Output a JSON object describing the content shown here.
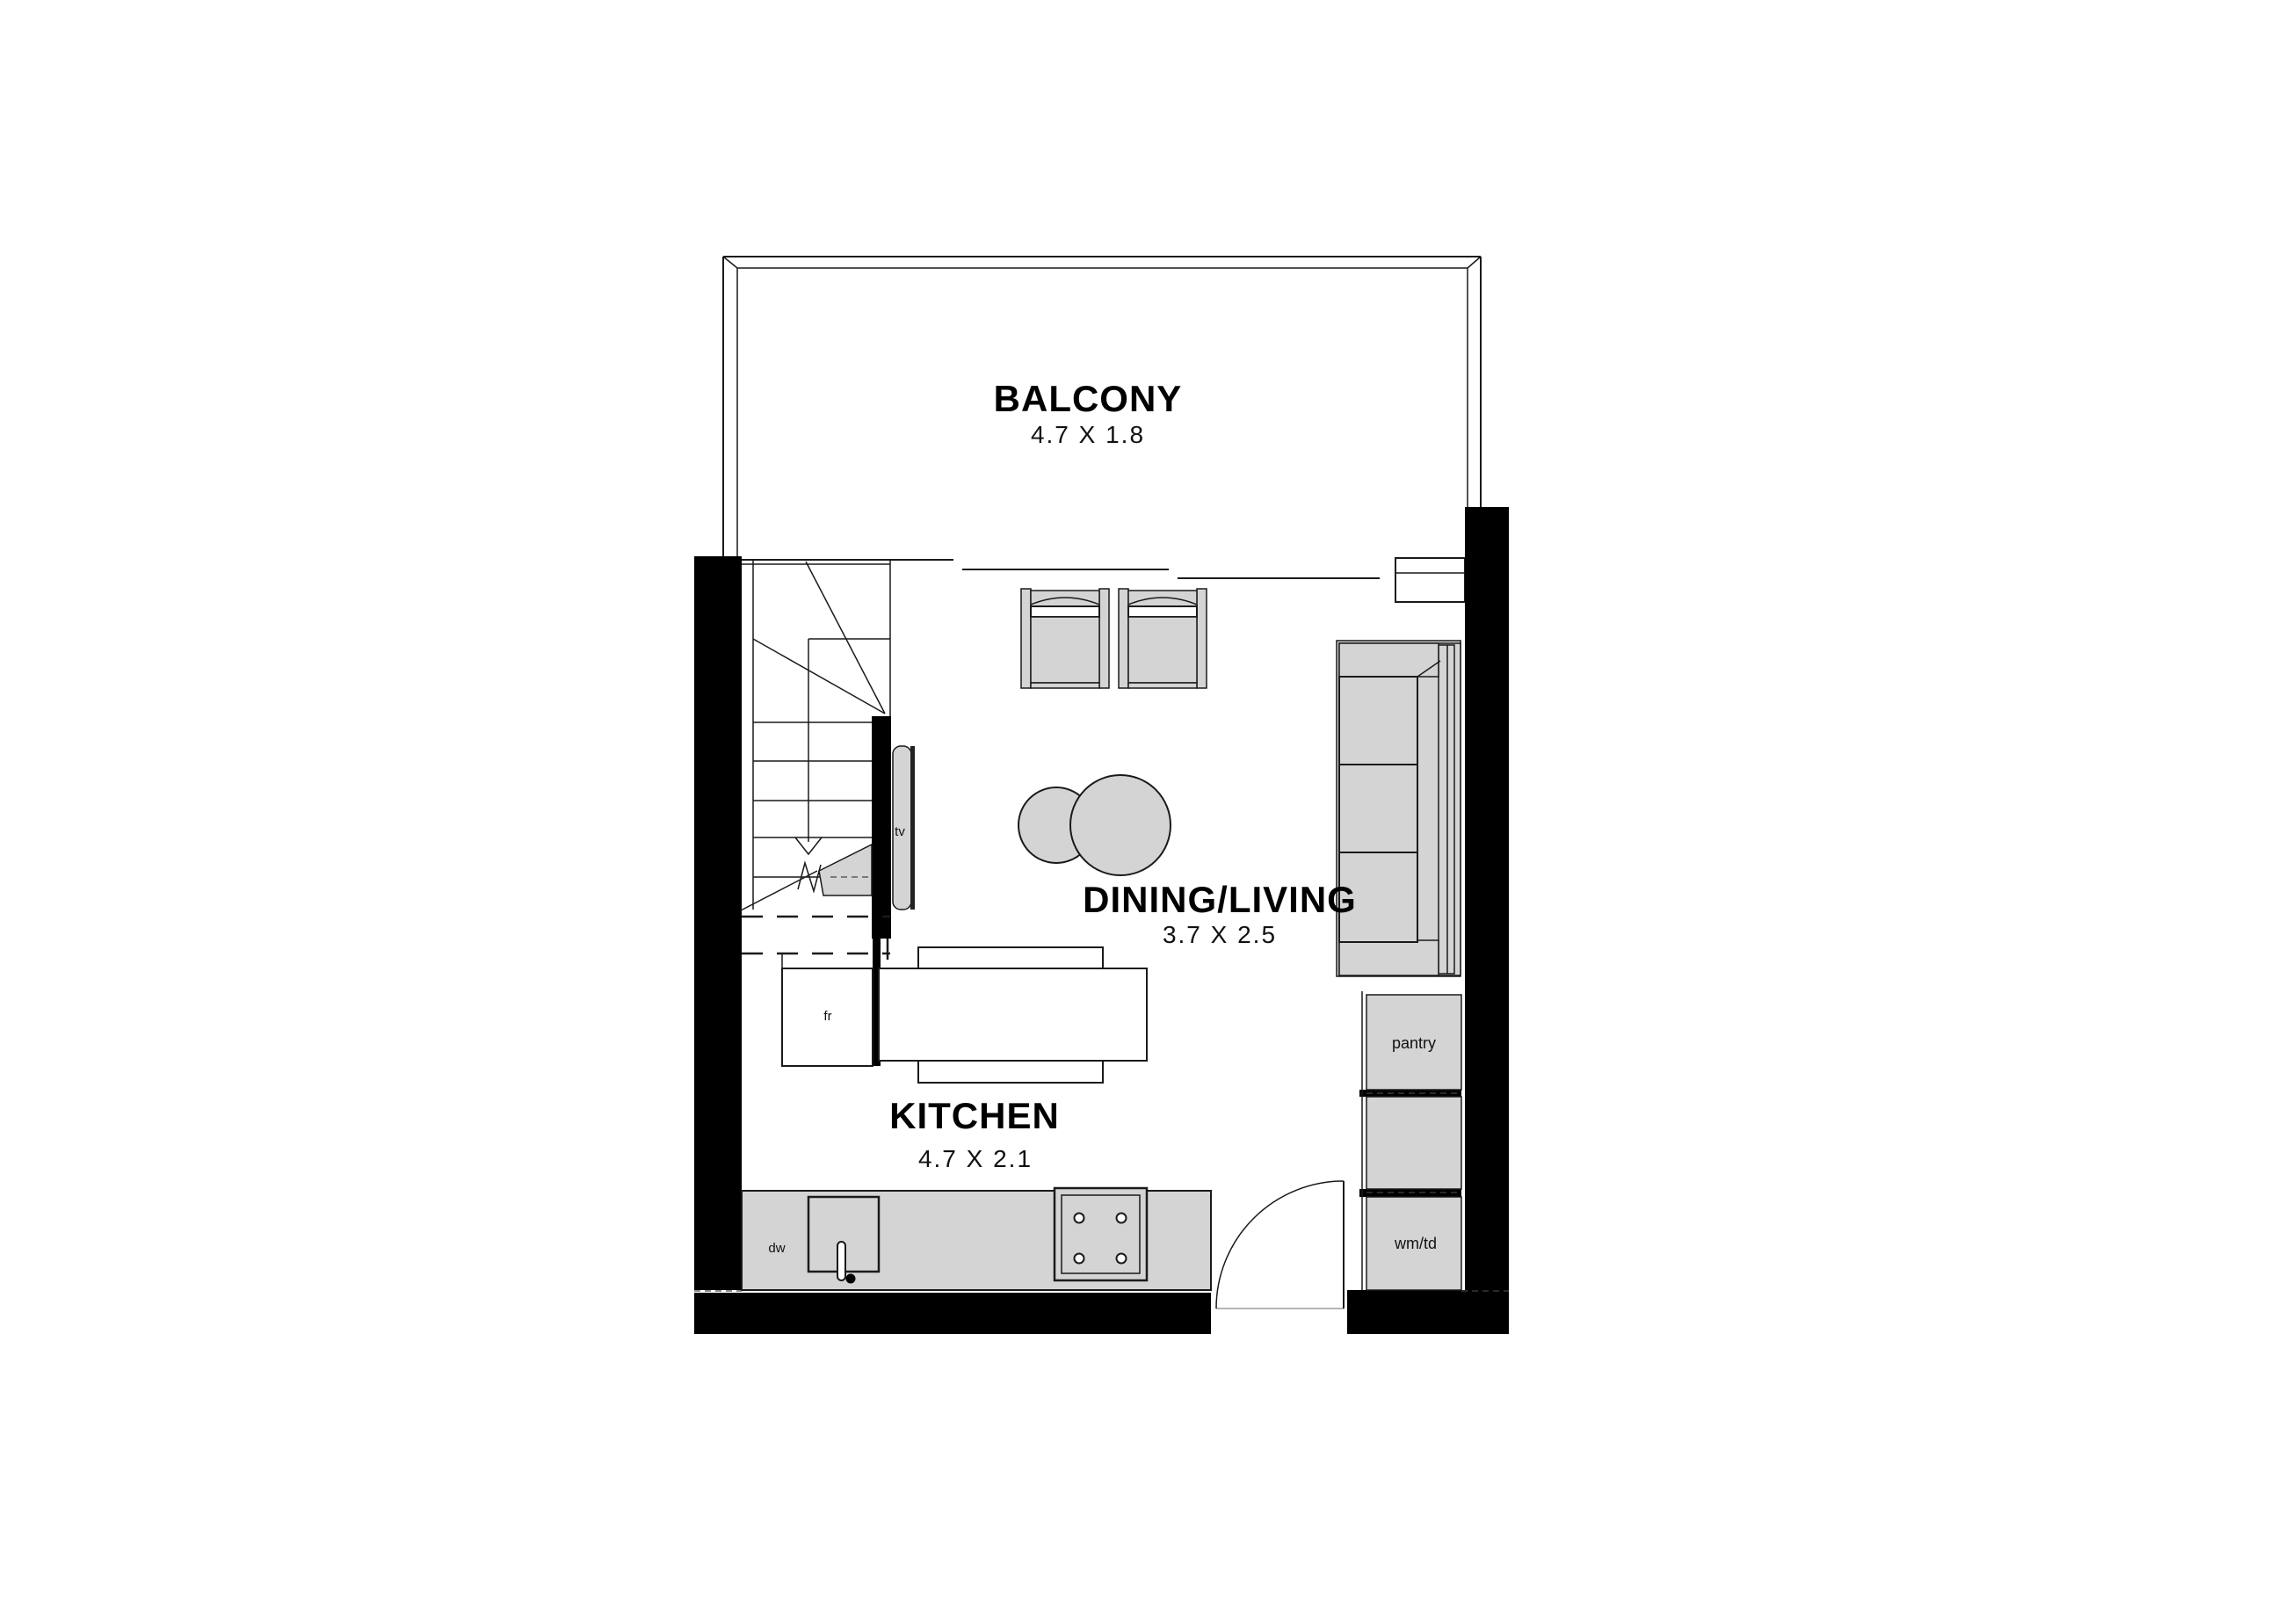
{
  "title": "Apartment floor plan — kitchen / dining / living level",
  "rooms": {
    "balcony": {
      "name": "BALCONY",
      "dims": "4.7 X 1.8"
    },
    "dining_living": {
      "name": "DINING/LIVING",
      "dims": "3.7 X 2.5"
    },
    "kitchen": {
      "name": "KITCHEN",
      "dims": "4.7 X 2.1"
    }
  },
  "fixtures": {
    "tv": "tv",
    "fridge": "fr",
    "dishwasher": "dw",
    "pantry": "pantry",
    "washer_dryer": "wm/td"
  },
  "colors": {
    "background": "#ffffff",
    "wall": "#000000",
    "line": "#1a1a1a",
    "furniture_fill": "#d4d4d4"
  }
}
